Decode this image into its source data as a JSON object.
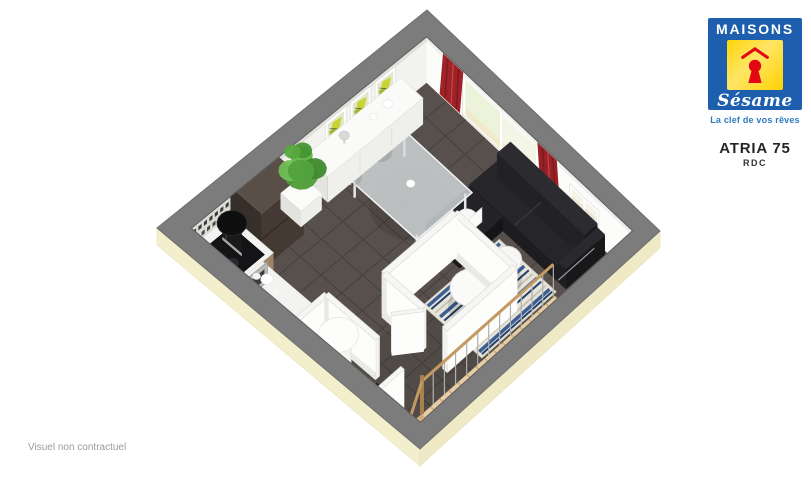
{
  "brand": {
    "word": "MAISONS",
    "script": "Sésame",
    "tagline": "La clef de vos rêves"
  },
  "plan": {
    "title": "ATRIA 75",
    "level": "RDC"
  },
  "footer": {
    "disclaimer": "Visuel non contractuel"
  },
  "palette": {
    "logo_blue": "#1d5fae",
    "logo_yellow": "#ffd608",
    "logo_red": "#e30613",
    "tagline_blue": "#2f7bc0",
    "wall_top_gray": "#7c7c7c",
    "wall_face_white": "#f8f8f6",
    "facade_trim_cream": "#f3eecb",
    "floor_tile": "#57504c",
    "floor_joint": "#48423e",
    "stair_wood": "#e6cda4",
    "rail_wood": "#c49a63",
    "curtain_red": "#9e2227",
    "door_glass": "#edf2da",
    "window_pane": "#eae4d4",
    "sofa_black": "#202024",
    "rug_base": "#e7e4d9",
    "rug_blue": "#3c5e93",
    "rug_navy": "#223f6b",
    "cabinet_wood": "#a08264",
    "counter_white": "#f3f3f1",
    "fridge_dark": "#443a33",
    "plant_green": "#4f9c39",
    "art_yellow": "#c8d334",
    "art_green": "#9bb32c"
  },
  "scene": {
    "label": "3D dollhouse cutaway render of ground floor plan",
    "elements": [
      {
        "name": "interior-wall-faces",
        "label": "white interior wall faces"
      },
      {
        "name": "art-frames",
        "label": "three abstract art frames"
      },
      {
        "name": "sliding-door",
        "label": "sliding glass patio door"
      },
      {
        "name": "curtains",
        "label": "red curtains"
      },
      {
        "name": "window",
        "label": "small window"
      },
      {
        "name": "tile-floor",
        "label": "dark gray tiled floor"
      },
      {
        "name": "sofa",
        "label": "black corner sofa"
      },
      {
        "name": "rug",
        "label": "blue striped rug"
      },
      {
        "name": "coffee-tables",
        "label": "two round white coffee tables"
      },
      {
        "name": "dining-table",
        "label": "glass dining table"
      },
      {
        "name": "dining-chairs",
        "label": "four white shell chairs"
      },
      {
        "name": "sideboard",
        "label": "white sideboard with vases"
      },
      {
        "name": "fridge",
        "label": "dark refrigerator"
      },
      {
        "name": "kitchen-counter",
        "label": "L-shaped kitchen counter with cooktop and oven"
      },
      {
        "name": "water-heater",
        "label": "white cylindrical water heater"
      },
      {
        "name": "storage-closet",
        "label": "dark open storage closet"
      },
      {
        "name": "wc-partition",
        "label": "WC partition walls with door"
      },
      {
        "name": "staircase",
        "label": "wooden staircase with winder"
      },
      {
        "name": "stair-railing",
        "label": "wooden stair railing"
      },
      {
        "name": "exterior-walls",
        "label": "gray wall tops and cream facade trim"
      },
      {
        "name": "extractor-hood",
        "label": "black cylindrical extractor hood"
      },
      {
        "name": "plant",
        "label": "green potted plant"
      }
    ]
  }
}
